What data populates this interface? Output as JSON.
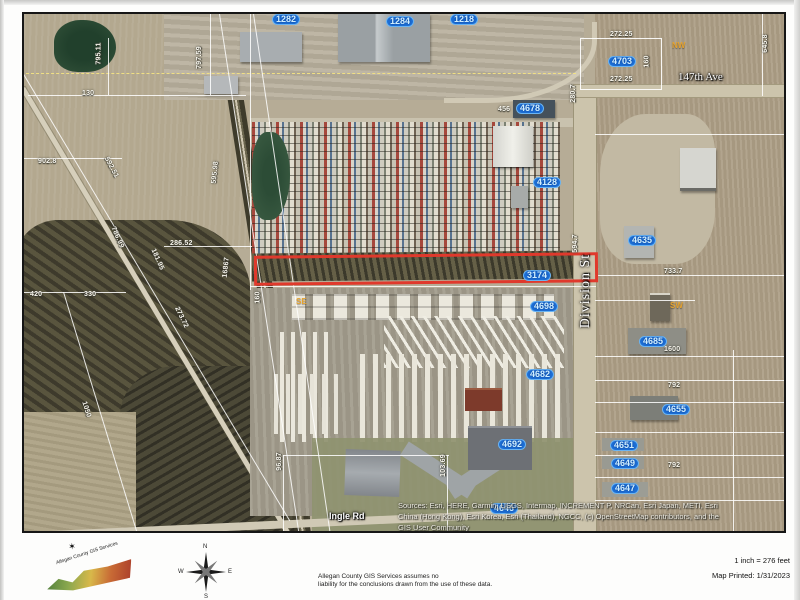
{
  "map": {
    "highlight_color": "#e0392c",
    "street_labels": [
      {
        "t": "147th Ave",
        "x": 654,
        "y": 58,
        "cls": "st-serif"
      },
      {
        "t": "Division St",
        "x": 525,
        "y": 270,
        "r": -90,
        "cls": "st-serif st-big"
      },
      {
        "t": "Ingle Rd",
        "x": 305,
        "y": 498,
        "cls": "st-sans"
      }
    ],
    "parcel_labels": [
      {
        "t": "1282",
        "x": 248,
        "y": 0
      },
      {
        "t": "1284",
        "x": 362,
        "y": 2
      },
      {
        "t": "1218",
        "x": 426,
        "y": 0
      },
      {
        "t": "4703",
        "x": 584,
        "y": 42
      },
      {
        "t": "4678",
        "x": 492,
        "y": 89
      },
      {
        "t": "4128",
        "x": 509,
        "y": 163
      },
      {
        "t": "4635",
        "x": 604,
        "y": 221
      },
      {
        "t": "3174",
        "x": 499,
        "y": 256
      },
      {
        "t": "4698",
        "x": 506,
        "y": 287
      },
      {
        "t": "4685",
        "x": 615,
        "y": 322
      },
      {
        "t": "4682",
        "x": 502,
        "y": 355
      },
      {
        "t": "4655",
        "x": 638,
        "y": 390
      },
      {
        "t": "4692",
        "x": 474,
        "y": 425
      },
      {
        "t": "4651",
        "x": 586,
        "y": 426
      },
      {
        "t": "4649",
        "x": 587,
        "y": 444
      },
      {
        "t": "4647",
        "x": 587,
        "y": 469
      },
      {
        "t": "4646",
        "x": 466,
        "y": 489
      }
    ],
    "dimension_labels": [
      {
        "t": "795.11",
        "x": 64,
        "y": 36,
        "r": -90
      },
      {
        "t": "797.59",
        "x": 164,
        "y": 40,
        "r": -90
      },
      {
        "t": "130",
        "x": 58,
        "y": 76
      },
      {
        "t": "902.8",
        "x": 14,
        "y": 144
      },
      {
        "t": "592.51",
        "x": 76,
        "y": 150,
        "r": 62
      },
      {
        "t": "595.98",
        "x": 180,
        "y": 155,
        "r": -84
      },
      {
        "t": "286.52",
        "x": 146,
        "y": 226
      },
      {
        "t": "786.99",
        "x": 82,
        "y": 220,
        "r": 66
      },
      {
        "t": "181.95",
        "x": 122,
        "y": 242,
        "r": 66
      },
      {
        "t": "16867",
        "x": 192,
        "y": 250,
        "r": -84
      },
      {
        "t": "420",
        "x": 6,
        "y": 277
      },
      {
        "t": "330",
        "x": 60,
        "y": 277
      },
      {
        "t": "273.72",
        "x": 146,
        "y": 300,
        "r": 64
      },
      {
        "t": "1050",
        "x": 54,
        "y": 392,
        "r": 72
      },
      {
        "t": "160",
        "x": 228,
        "y": 280,
        "r": -90
      },
      {
        "t": "96.87",
        "x": 246,
        "y": 444,
        "r": -90
      },
      {
        "t": "103.69",
        "x": 408,
        "y": 448,
        "r": -90
      },
      {
        "t": "272.25",
        "x": 586,
        "y": 17
      },
      {
        "t": "272.25",
        "x": 586,
        "y": 62
      },
      {
        "t": "160",
        "x": 617,
        "y": 44,
        "r": -90
      },
      {
        "t": "645.8",
        "x": 732,
        "y": 26,
        "r": -90
      },
      {
        "t": "280.7",
        "x": 540,
        "y": 76,
        "r": -90
      },
      {
        "t": "594.7",
        "x": 542,
        "y": 226,
        "r": -90
      },
      {
        "t": "733.7",
        "x": 640,
        "y": 254
      },
      {
        "t": "1600",
        "x": 640,
        "y": 332
      },
      {
        "t": "792",
        "x": 644,
        "y": 368
      },
      {
        "t": "792",
        "x": 644,
        "y": 448
      },
      {
        "t": "456",
        "x": 474,
        "y": 92
      }
    ],
    "quadrant_labels": [
      {
        "t": "NW",
        "x": 648,
        "y": 28
      },
      {
        "t": "SW",
        "x": 646,
        "y": 288
      },
      {
        "t": "SE",
        "x": 272,
        "y": 284
      }
    ],
    "attribution": {
      "line1": "Sources: Esri, HERE, Garmin, USGS, Intermap, INCREMENT P, NRCan, Esri Japan, METI, Esri",
      "line2": "China (Hong Kong), Esri Korea, Esri (Thailand), NGCC, (c) OpenStreetMap contributors, and the",
      "line3": "GIS User Community"
    }
  },
  "footer": {
    "logo_text": "Allegan County GIS Services",
    "compass": {
      "n": "N",
      "e": "E",
      "s": "S",
      "w": "W"
    },
    "disclaimer_line1": "Allegan County GIS Services assumes no",
    "disclaimer_line2": "liability for the conclusions drawn from the use of these data.",
    "scale_text": "1 inch = 276 feet",
    "printed_text": "Map Printed: 1/31/2023"
  }
}
